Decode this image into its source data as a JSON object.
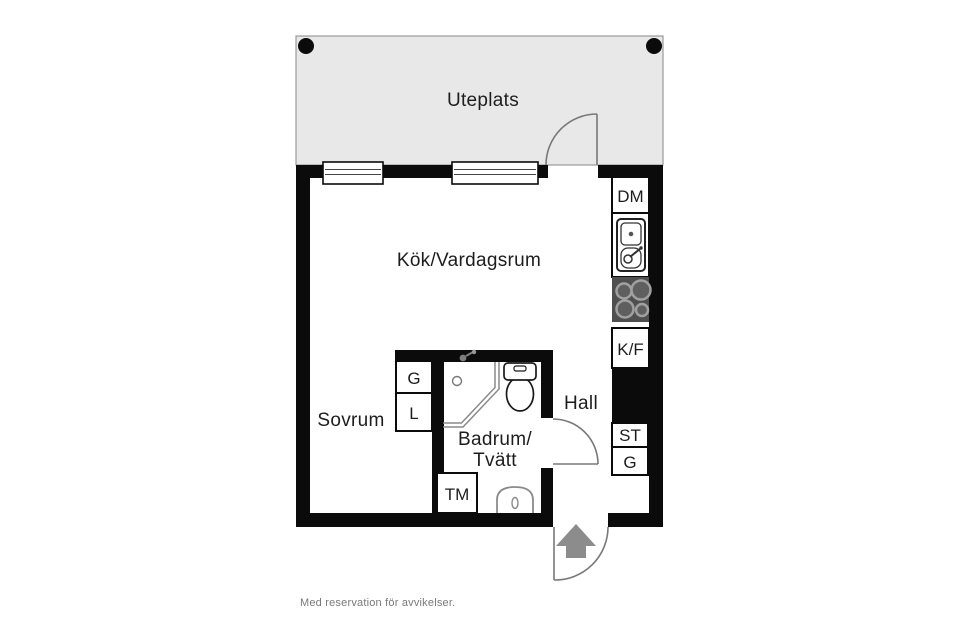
{
  "floorplan": {
    "outdoor": {
      "patio_label": "Uteplats"
    },
    "rooms": {
      "kitchen_living": "Kök/Vardagsrum",
      "bedroom": "Sovrum",
      "bathroom_line1": "Badrum/",
      "bathroom_line2": "Tvätt",
      "hall": "Hall"
    },
    "appliances": {
      "dishwasher": "DM",
      "fridge_freezer": "K/F",
      "cleaning_closet": "ST",
      "hall_wardrobe": "G",
      "bedroom_wardrobe": "G",
      "bedroom_linen_closet": "L",
      "washing_machine": "TM"
    },
    "footer_note": "Med reservation för avvikelser.",
    "colors": {
      "wall": "#0b0b0b",
      "patio_fill": "#e8e8e8",
      "patio_border": "#9a9a9a",
      "stove_bg": "#4f4f4f",
      "burner_ring": "#a0a0a0",
      "burner_fill": "#5f5f5f",
      "entry_arrow": "#8c8c8c",
      "door_swing": "#787878",
      "fixture_gray": "#8a8a8a",
      "label_text": "#1d1d1d",
      "footer_text": "#7a7a7a"
    }
  }
}
